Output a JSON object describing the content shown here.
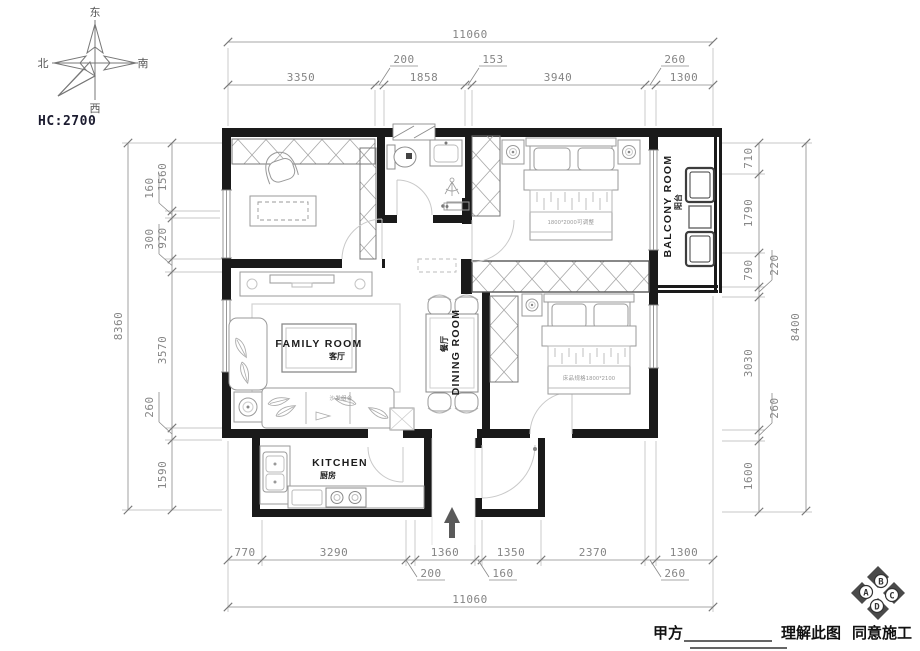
{
  "title_block": {
    "hc_label": "HC:2700"
  },
  "compass": {
    "top": "东",
    "left": "北",
    "right": "南",
    "bottom": "西"
  },
  "rooms": {
    "family_room": {
      "en": "FAMILY ROOM",
      "zh": "客厅"
    },
    "dining_room": {
      "en": "DINING ROOM",
      "zh": "餐厅"
    },
    "kitchen": {
      "en": "KITCHEN",
      "zh": "厨房"
    },
    "balcony": {
      "en": "BALCONY ROOM",
      "zh": "阳台"
    }
  },
  "furniture_notes": {
    "master_bed": "1800*2000可调整",
    "second_bed": "床品规格1800*2100",
    "sofa": "沙发组合"
  },
  "dimensions": {
    "top": {
      "overall": "11060",
      "segments": [
        "3350",
        "200",
        "1858",
        "153",
        "3940",
        "260",
        "1300"
      ]
    },
    "bottom": {
      "overall": "11060",
      "segments": [
        "770",
        "3290",
        "200",
        "1360",
        "160",
        "1350",
        "2370",
        "260",
        "1300"
      ]
    },
    "left": {
      "overall": "8360",
      "segments": [
        "1560",
        "160",
        "920",
        "300",
        "3570",
        "260",
        "1590"
      ]
    },
    "right": {
      "overall": "8400",
      "segments": [
        "710",
        "1790",
        "790",
        "220",
        "3030",
        "260",
        "1600"
      ]
    }
  },
  "footer": {
    "party_a": "甲方",
    "understand": "理解此图",
    "agree": "同意施工",
    "badge": {
      "top": "B",
      "left": "A",
      "right": "C",
      "bottom": "D"
    }
  },
  "colors": {
    "wall": "#1a1a1a",
    "dimension_line": "#8a8a8a",
    "furniture_line": "#9a9a9a",
    "label_text": "#1c1c1c"
  }
}
